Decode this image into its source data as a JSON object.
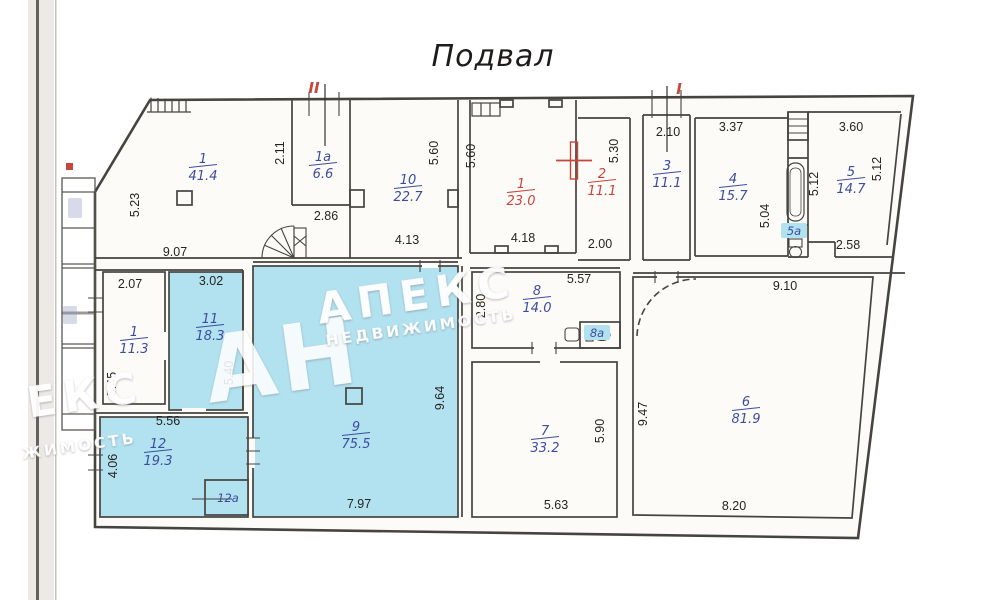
{
  "title": "Подвал",
  "colors": {
    "highlight": "#b2e1ef",
    "wall": "#46443f",
    "label_blue": "#3c4da0",
    "label_red": "#c7453a",
    "dimension_text": "#26241f",
    "marker_red": "#c7453a"
  },
  "rooms": [
    {
      "number": "1",
      "area": "41.4",
      "color": "blue",
      "x": 203,
      "y": 163
    },
    {
      "number": "1а",
      "area": "6.6",
      "color": "blue",
      "x": 323,
      "y": 161
    },
    {
      "number": "10",
      "area": "22.7",
      "color": "blue",
      "x": 408,
      "y": 184
    },
    {
      "number": "1",
      "area": "23.0",
      "color": "red",
      "x": 521,
      "y": 188
    },
    {
      "number": "2",
      "area": "11.1",
      "color": "red",
      "x": 602,
      "y": 178
    },
    {
      "number": "3",
      "area": "11.1",
      "color": "blue",
      "x": 667,
      "y": 170
    },
    {
      "number": "4",
      "area": "15.7",
      "color": "blue",
      "x": 733,
      "y": 183
    },
    {
      "number": "5",
      "area": "14.7",
      "color": "blue",
      "x": 851,
      "y": 176
    },
    {
      "number": "1",
      "area": "11.3",
      "color": "blue",
      "x": 134,
      "y": 336
    },
    {
      "number": "11",
      "area": "18.3",
      "color": "blue",
      "x": 210,
      "y": 323
    },
    {
      "number": "8",
      "area": "14.0",
      "color": "blue",
      "x": 537,
      "y": 295
    },
    {
      "number": "9",
      "area": "75.5",
      "color": "blue",
      "x": 356,
      "y": 431
    },
    {
      "number": "7",
      "area": "33.2",
      "color": "blue",
      "x": 545,
      "y": 435
    },
    {
      "number": "6",
      "area": "81.9",
      "color": "blue",
      "x": 746,
      "y": 406
    },
    {
      "number": "12",
      "area": "19.3",
      "color": "blue",
      "x": 158,
      "y": 448
    }
  ],
  "small_room_labels": [
    {
      "label": "5а",
      "x": 794,
      "y": 232,
      "chip": true
    },
    {
      "label": "8а",
      "x": 597,
      "y": 334,
      "chip": true
    },
    {
      "label": "12а",
      "x": 228,
      "y": 499,
      "chip": false
    }
  ],
  "dimensions": [
    {
      "value": "5.23",
      "x": 139,
      "y": 205,
      "vertical": true
    },
    {
      "value": "9.07",
      "x": 175,
      "y": 256,
      "vertical": false
    },
    {
      "value": "2.11",
      "x": 284,
      "y": 153,
      "vertical": true
    },
    {
      "value": "2.86",
      "x": 326,
      "y": 220,
      "vertical": false
    },
    {
      "value": "5.60",
      "x": 438,
      "y": 153,
      "vertical": true
    },
    {
      "value": "4.13",
      "x": 407,
      "y": 244,
      "vertical": false
    },
    {
      "value": "5.60",
      "x": 475,
      "y": 156,
      "vertical": true
    },
    {
      "value": "4.18",
      "x": 523,
      "y": 242,
      "vertical": false
    },
    {
      "value": "5.30",
      "x": 618,
      "y": 151,
      "vertical": true
    },
    {
      "value": "2.00",
      "x": 600,
      "y": 248,
      "vertical": false
    },
    {
      "value": "2.10",
      "x": 668,
      "y": 136,
      "vertical": false
    },
    {
      "value": "3.37",
      "x": 731,
      "y": 131,
      "vertical": false
    },
    {
      "value": "5.04",
      "x": 769,
      "y": 216,
      "vertical": true
    },
    {
      "value": "3.60",
      "x": 851,
      "y": 131,
      "vertical": false
    },
    {
      "value": "5.12",
      "x": 818,
      "y": 184,
      "vertical": true
    },
    {
      "value": "5.12",
      "x": 881,
      "y": 169,
      "vertical": true
    },
    {
      "value": "2.58",
      "x": 848,
      "y": 249,
      "vertical": false
    },
    {
      "value": "2.07",
      "x": 130,
      "y": 288,
      "vertical": false
    },
    {
      "value": "3.02",
      "x": 211,
      "y": 285,
      "vertical": false
    },
    {
      "value": "5.45",
      "x": 116,
      "y": 384,
      "vertical": true
    },
    {
      "value": "5.40",
      "x": 233,
      "y": 373,
      "vertical": true
    },
    {
      "value": "5.56",
      "x": 168,
      "y": 425,
      "vertical": false
    },
    {
      "value": "2.80",
      "x": 485,
      "y": 306,
      "vertical": true
    },
    {
      "value": "5.57",
      "x": 579,
      "y": 283,
      "vertical": false
    },
    {
      "value": "9.10",
      "x": 785,
      "y": 290,
      "vertical": false
    },
    {
      "value": "9.64",
      "x": 444,
      "y": 398,
      "vertical": true
    },
    {
      "value": "9.47",
      "x": 647,
      "y": 414,
      "vertical": true
    },
    {
      "value": "4.06",
      "x": 117,
      "y": 466,
      "vertical": true
    },
    {
      "value": "7.97",
      "x": 359,
      "y": 508,
      "vertical": false
    },
    {
      "value": "5.90",
      "x": 604,
      "y": 431,
      "vertical": true
    },
    {
      "value": "5.63",
      "x": 556,
      "y": 509,
      "vertical": false
    },
    {
      "value": "8.20",
      "x": 734,
      "y": 510,
      "vertical": false
    }
  ],
  "entry_markers": [
    {
      "label": "II",
      "x": 314,
      "y": 93
    },
    {
      "label": "I",
      "x": 679,
      "y": 94
    }
  ],
  "watermark": {
    "initials": "АН",
    "brand": "АПЕКС",
    "subtitle": "НЕДВИЖИМОСТЬ",
    "partial_brand": "ЕКС",
    "partial_subtitle": "ЖИМОСТЬ"
  }
}
